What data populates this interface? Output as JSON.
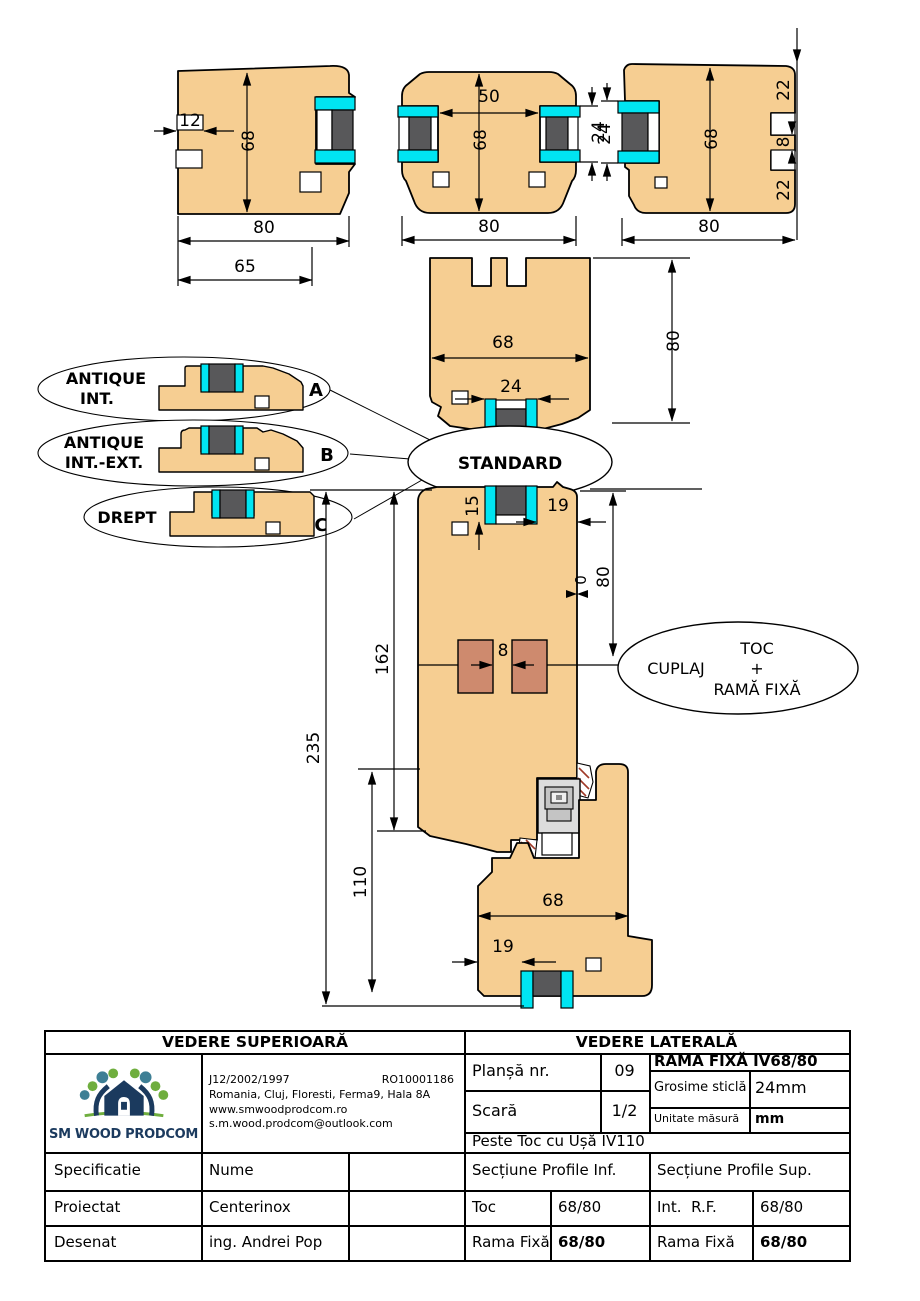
{
  "colors": {
    "wood": "#F6CE92",
    "glass": "#58585A",
    "gasket": "#00E5F2",
    "dowel": "#CE8A6E",
    "hatch": "#A03A28",
    "logo_navy": "#1B3A5E",
    "logo_green": "#6FAE3E",
    "logo_teal": "#3E7F95"
  },
  "drawing": {
    "top_left": {
      "d12": "12",
      "d68": "68",
      "d80": "80",
      "d65": "65"
    },
    "top_mid": {
      "d50": "50",
      "d68": "68",
      "d24": "24",
      "d80": "80"
    },
    "top_right": {
      "d22a": "22",
      "d8": "8",
      "d22b": "22",
      "d68": "68",
      "d80": "80",
      "d24": "24"
    },
    "head": {
      "d68": "68",
      "d24": "24",
      "d80": "80"
    },
    "mid": {
      "d15": "15",
      "d19": "19",
      "d0": "0",
      "d80": "80",
      "d162": "162",
      "d235": "235",
      "d8": "8"
    },
    "bottom": {
      "d110": "110",
      "d68": "68",
      "d19": "19"
    },
    "callouts": {
      "a1": "ANTIQUE",
      "a2": "INT.",
      "a": "A",
      "b1": "ANTIQUE",
      "b2": "INT.-EXT.",
      "b": "B",
      "c1": "DREPT",
      "c": "C",
      "standard": "STANDARD",
      "cuplaj": "CUPLAJ",
      "toc": "TOC",
      "plus": "+",
      "rama": "RAMĂ FIXĂ"
    }
  },
  "table": {
    "header_left": "VEDERE SUPERIOARĂ",
    "header_right": "VEDERE LATERALĂ",
    "logo_text": "SM WOOD PRODCOM",
    "company": {
      "reg": "J12/2002/1997",
      "cui": "RO10001186",
      "address": "Romania, Cluj, Floresti, Ferma9, Hala 8A",
      "web": "www.smwoodprodcom.ro",
      "email": "s.m.wood.prodcom@outlook.com"
    },
    "plansa_label": "Planșă nr.",
    "plansa_value": "09",
    "product_title": "RAMA FIXĂ IV68/80",
    "grosime_label": "Grosime sticlă",
    "grosime_value": "24mm",
    "scara_label": "Scară",
    "scara_value": "1/2",
    "unitate_label": "Unitate măsură",
    "unitate_value": "mm",
    "peste": "Peste Toc cu Ușă IV110",
    "spec_label": "Specificatie",
    "nume_label": "Nume",
    "sect_inf": "Secțiune Profile Inf.",
    "sect_sup": "Secțiune Profile Sup.",
    "proiectat_label": "Proiectat",
    "proiectat_value": "Centerinox",
    "toc_label": "Toc",
    "toc_value": "68/80",
    "int_rf_label": "Int.  R.F.",
    "int_rf_value": "68/80",
    "desenat_label": "Desenat",
    "desenat_value": "ing. Andrei Pop",
    "rama_inf_label": "Rama Fixă",
    "rama_inf_value": "68/80",
    "rama_sup_label": "Rama Fixă",
    "rama_sup_value": "68/80"
  }
}
